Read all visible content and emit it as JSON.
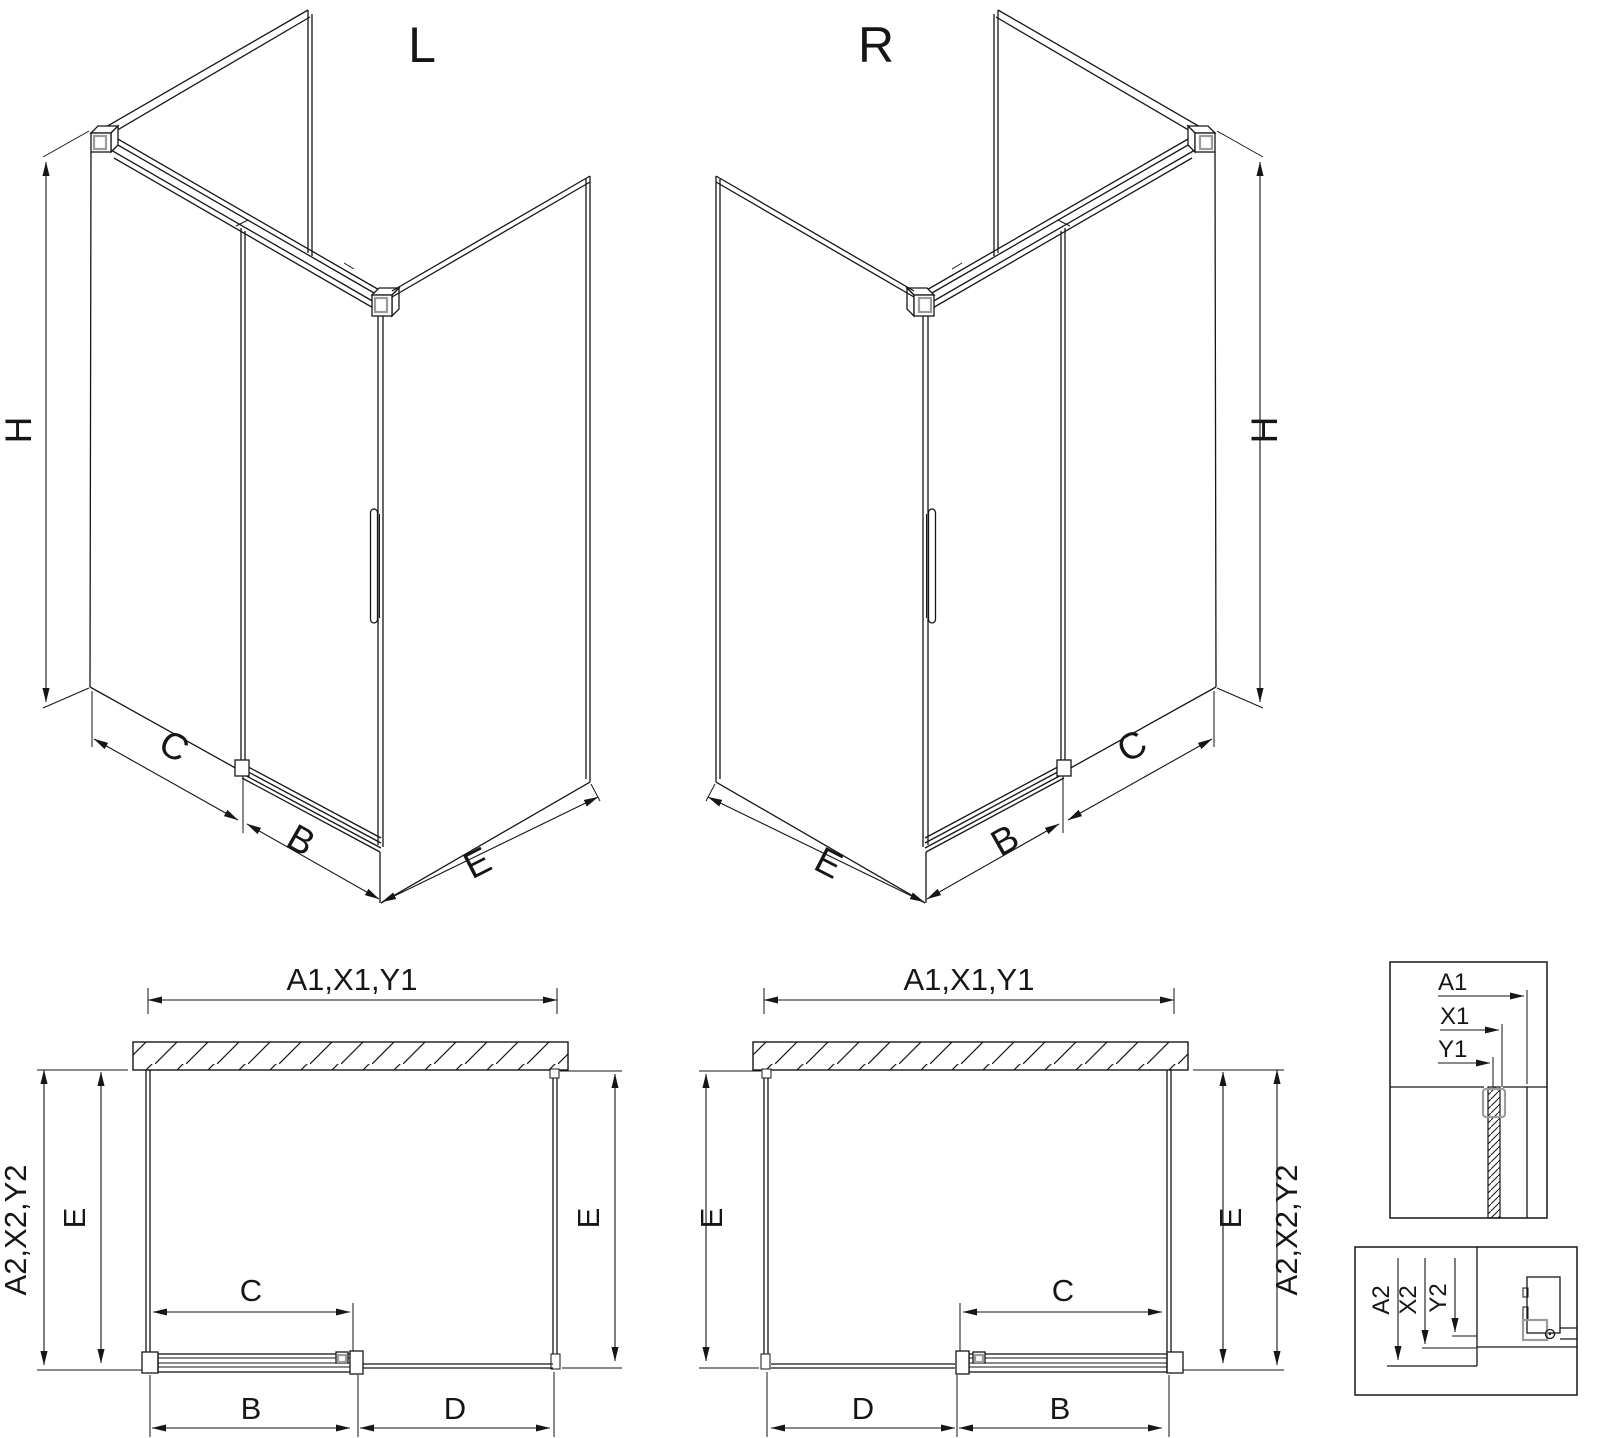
{
  "sheet": {
    "background": "#ffffff",
    "line_color": "#161616",
    "accent_color": "#9b9b9b"
  },
  "iso_left": {
    "title": "L",
    "dim_height": "H",
    "dim_fixed_panel": "C",
    "dim_door": "B",
    "dim_side_panel": "E"
  },
  "iso_right": {
    "title": "R",
    "dim_height": "H",
    "dim_fixed_panel": "C",
    "dim_door": "B",
    "dim_side_panel": "E"
  },
  "plan_left": {
    "dim_total_width": "A1,X1,Y1",
    "dim_total_depth": "A2,X2,Y2",
    "dim_depth_left": "E",
    "dim_depth_right": "E",
    "dim_slide_width": "C",
    "dim_door_width": "B",
    "dim_fixed_width": "D"
  },
  "plan_right": {
    "dim_total_width": "A1,X1,Y1",
    "dim_total_depth": "A2,X2,Y2",
    "dim_depth_left": "E",
    "dim_depth_right": "E",
    "dim_slide_width": "C",
    "dim_door_width": "B",
    "dim_fixed_width": "D"
  },
  "detail_wall_section": {
    "labels": [
      "A1",
      "X1",
      "Y1"
    ]
  },
  "detail_floor_section": {
    "labels": [
      "A2",
      "X2",
      "Y2"
    ]
  }
}
